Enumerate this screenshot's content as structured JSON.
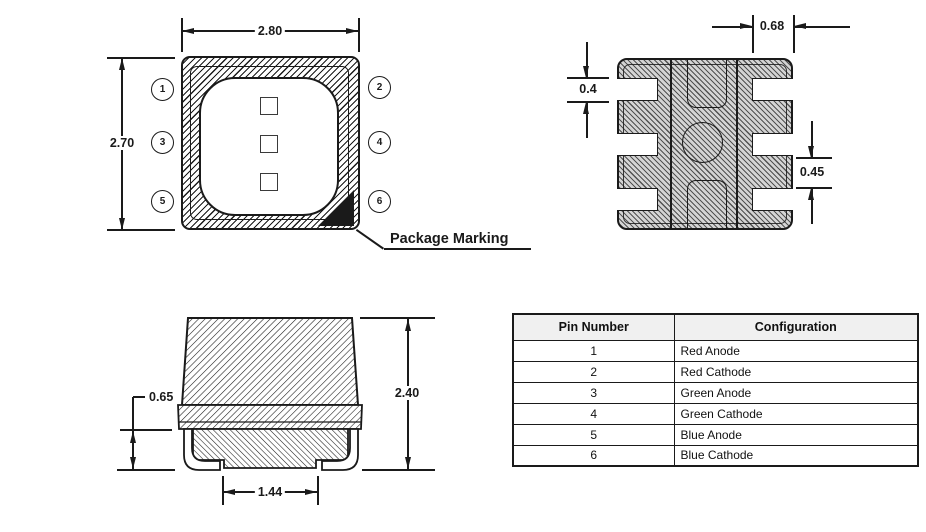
{
  "top_view": {
    "dim_width": "2.80",
    "dim_height": "2.70",
    "marking_label": "Package Marking",
    "pins_left": [
      "1",
      "3",
      "5"
    ],
    "pins_right": [
      "2",
      "4",
      "6"
    ]
  },
  "bottom_view": {
    "dim_pad_width": "0.68",
    "dim_pad_height": "0.4",
    "dim_pad_gap": "0.45"
  },
  "side_view": {
    "dim_standoff": "0.65",
    "dim_total_height": "2.40",
    "dim_bottom_pad_width": "1.44"
  },
  "pin_table": {
    "headers": [
      "Pin Number",
      "Configuration"
    ],
    "rows": [
      [
        "1",
        "Red Anode"
      ],
      [
        "2",
        "Red Cathode"
      ],
      [
        "3",
        "Green Anode"
      ],
      [
        "4",
        "Green Cathode"
      ],
      [
        "5",
        "Blue Anode"
      ],
      [
        "6",
        "Blue Cathode"
      ]
    ]
  },
  "colors": {
    "ink": "#1a1a1a",
    "table_header_bg": "#f0f0f0"
  }
}
